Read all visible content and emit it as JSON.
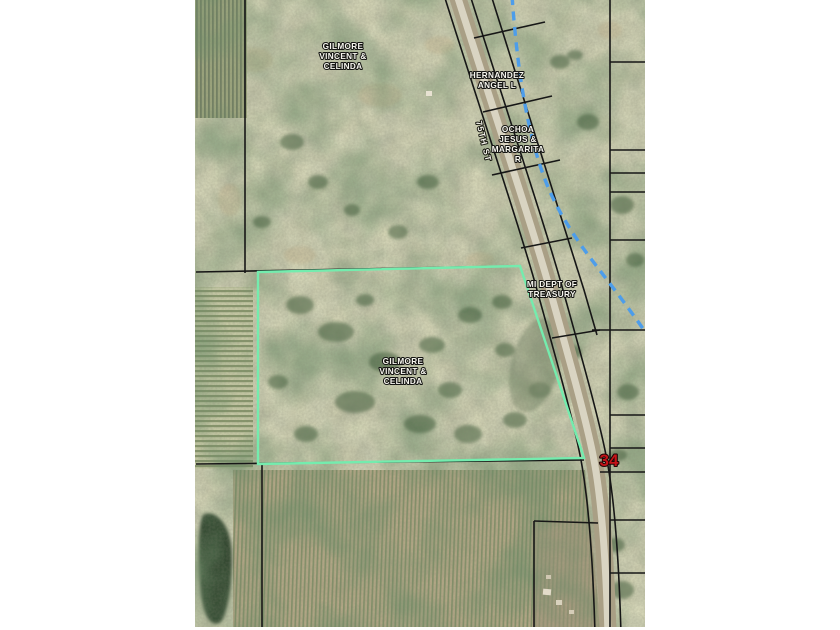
{
  "viewer": {
    "map": {
      "kind": "parcel-aerial-map",
      "road_label": "75TH ST",
      "section_number": "34",
      "colors": {
        "section_number": "#c51318",
        "selected_parcel_outline": "#74ecae",
        "stream_dashed": "#4d9dea",
        "parcel_boundary": "#161616",
        "page_margin": "#ffffff"
      },
      "labels": {
        "owner_gilmore_north": {
          "lines": [
            "GILMORE",
            "VINCENT &",
            "CELINDA"
          ]
        },
        "owner_hernandez": {
          "lines": [
            "HERNANDEZ",
            "ANGEL L"
          ]
        },
        "owner_ochoa": {
          "lines": [
            "OCHOA",
            "JESUS &",
            "MARGARITA",
            "R"
          ]
        },
        "owner_treasury": {
          "lines": [
            "MI DEPT OF",
            "TREASURY"
          ]
        },
        "owner_gilmore_selected": {
          "lines": [
            "GILMORE",
            "VINCENT &",
            "CELINDA"
          ]
        }
      }
    }
  }
}
